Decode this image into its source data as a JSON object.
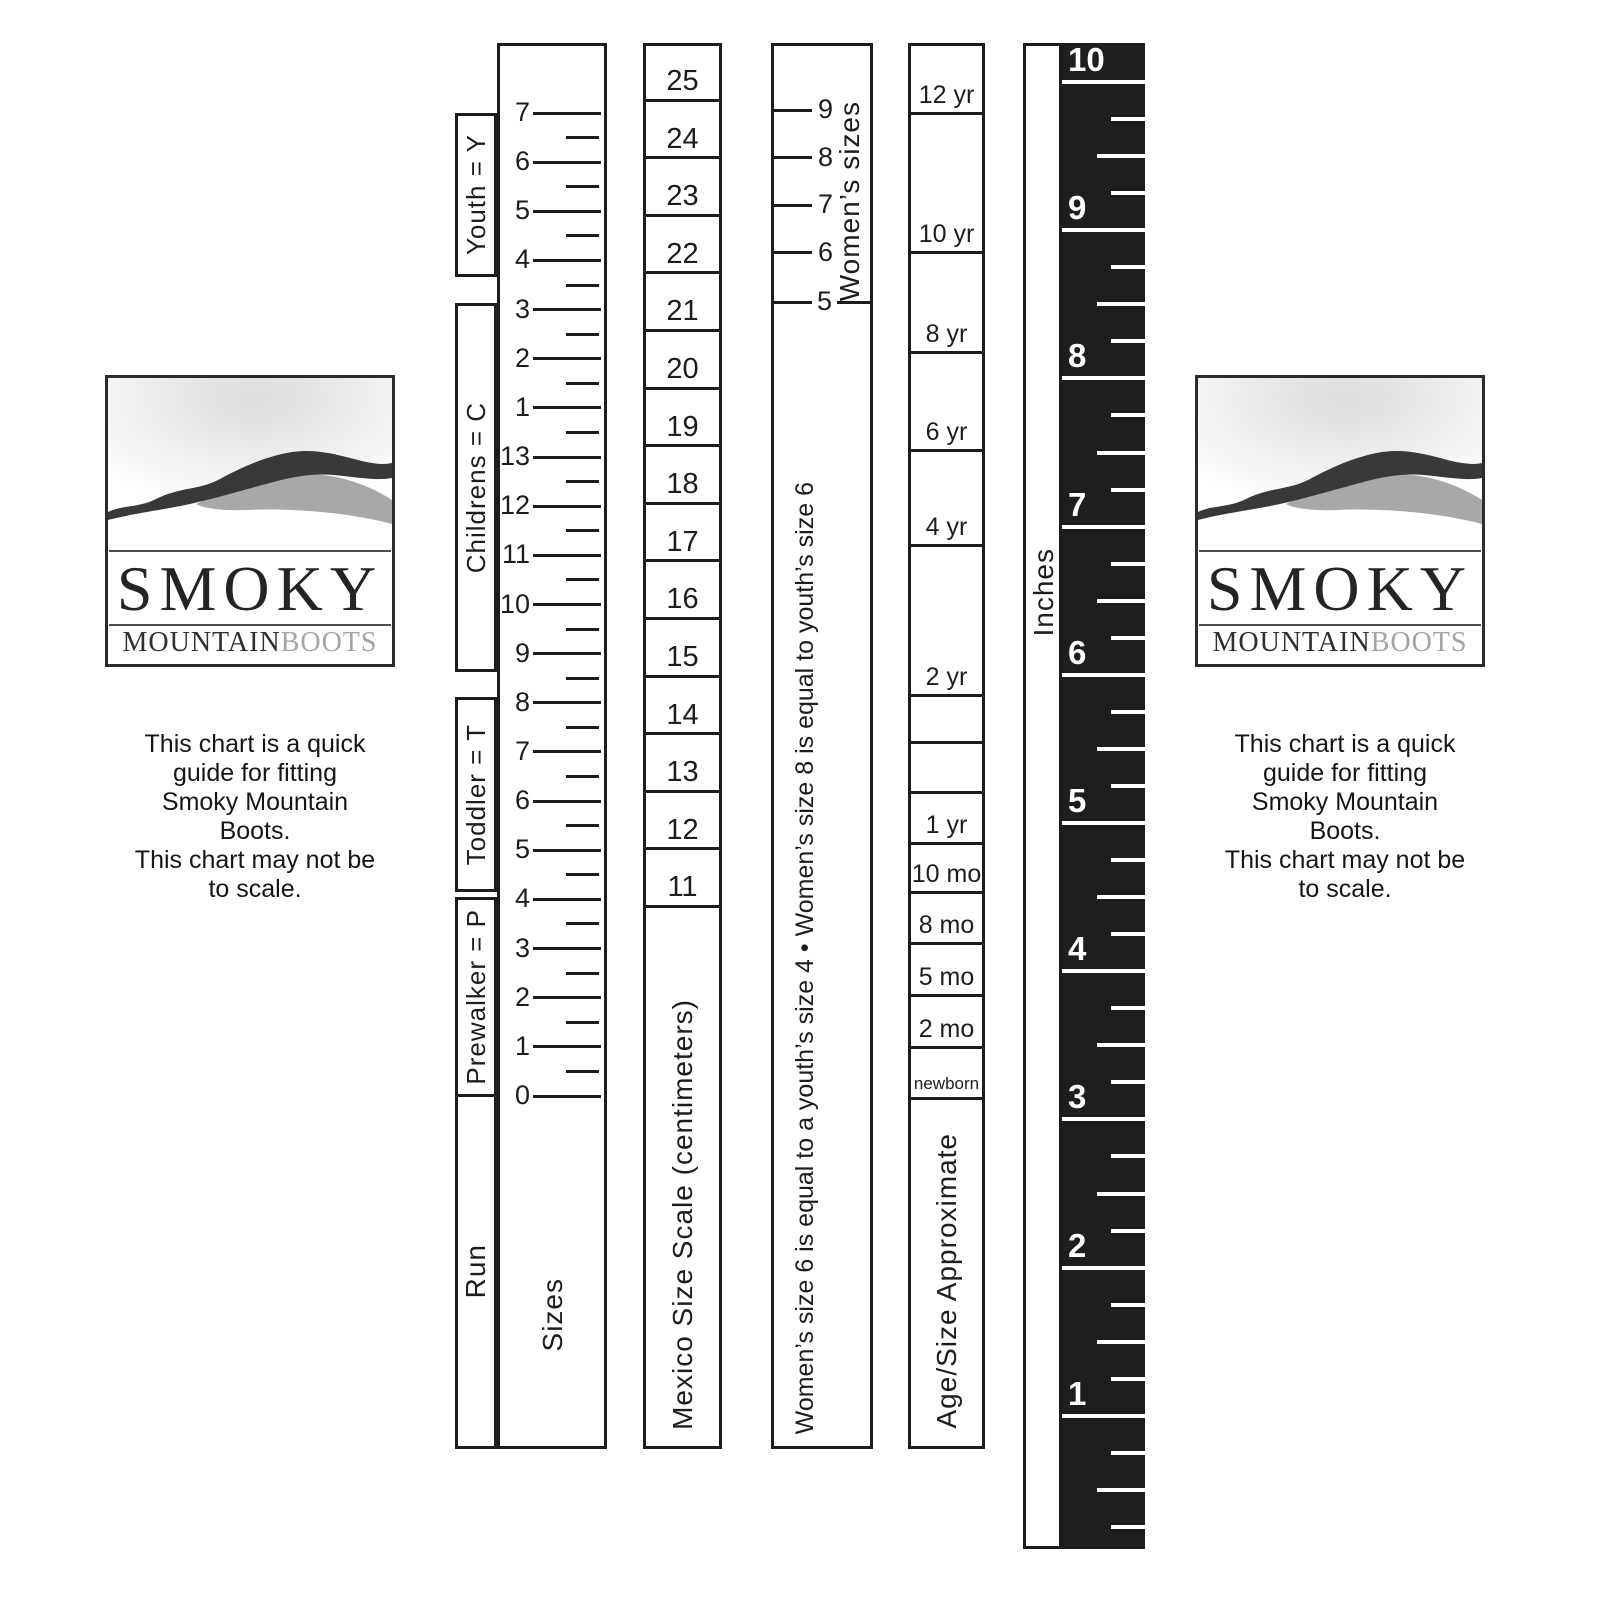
{
  "logo": {
    "title": "SMOKY",
    "subtitle_primary": "MOUNTAIN",
    "subtitle_secondary": "BOOTS"
  },
  "info_note": {
    "text": "This chart is a quick\nguide for fitting\nSmoky Mountain\nBoots.\nThis chart may not be\nto scale."
  },
  "size_ruler": {
    "column_label": "Run",
    "scale_label": "Sizes",
    "brackets": [
      "Youth = Y",
      "Childrens = C",
      "Toddler = T",
      "Prewalker = P"
    ],
    "ticks": [
      "7",
      "6",
      "5",
      "4",
      "3",
      "2",
      "1",
      "13",
      "12",
      "11",
      "10",
      "9",
      "8",
      "7",
      "6",
      "5",
      "4",
      "3",
      "2",
      "1",
      "0"
    ]
  },
  "mexico_ruler": {
    "scale_label": "Mexico Size Scale (centimeters)",
    "ticks": [
      "25",
      "24",
      "23",
      "22",
      "21",
      "20",
      "19",
      "18",
      "17",
      "16",
      "15",
      "14",
      "13",
      "12",
      "11"
    ]
  },
  "womens_ruler": {
    "scale_label": "Women’s sizes",
    "ticks": [
      "9",
      "8",
      "7",
      "6"
    ],
    "boundary_tick": "5",
    "note": "Women’s size 6 is equal to a youth’s size 4 • Women’s size 8 is equal to youth’s size 6"
  },
  "age_ruler": {
    "scale_label": "Age/Size Approximate",
    "cells": [
      "12 yr",
      "10 yr",
      "8 yr",
      "6 yr",
      "4 yr",
      "2 yr",
      "",
      "",
      "1 yr",
      "10 mo",
      "8 mo",
      "5 mo",
      "2 mo",
      "newborn"
    ]
  },
  "inches_ruler": {
    "scale_label": "Inches",
    "ticks": [
      "10",
      "9",
      "8",
      "7",
      "6",
      "5",
      "4",
      "3",
      "2",
      "1"
    ]
  },
  "colors": {
    "ink": "#1d1d1f",
    "ruler_black": "#1e1e20",
    "ridge_dark": "#39393b",
    "ridge_light": "#a8a8aa",
    "boots_gray": "#a4a4a6"
  }
}
